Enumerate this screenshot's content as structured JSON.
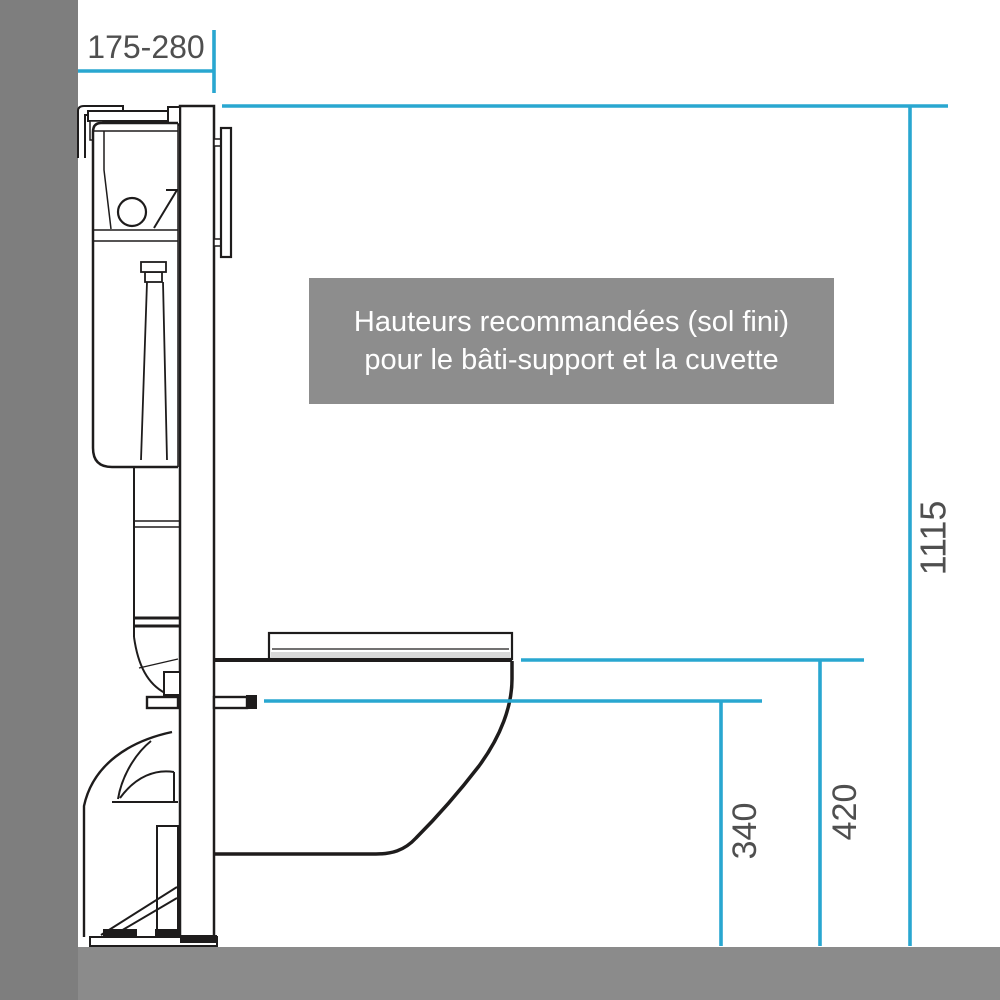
{
  "banner": {
    "line1": "Hauteurs recommandées (sol fini)",
    "line2": "pour le bâti-support et la cuvette"
  },
  "dimensions": {
    "frame_depth_range": "175-280",
    "frame_total_height": "1115",
    "bowl_rim_height": "420",
    "fixing_arm_height": "340"
  },
  "colors": {
    "dimension_line": "#29a7d0",
    "drawing_line": "#1e1c1c",
    "label_text": "#4f4f4f",
    "wall_gray": "#7e7e7e",
    "floor_gray": "#8b8b8b",
    "banner_gray": "#8d8d8d",
    "banner_text": "#ffffff"
  }
}
